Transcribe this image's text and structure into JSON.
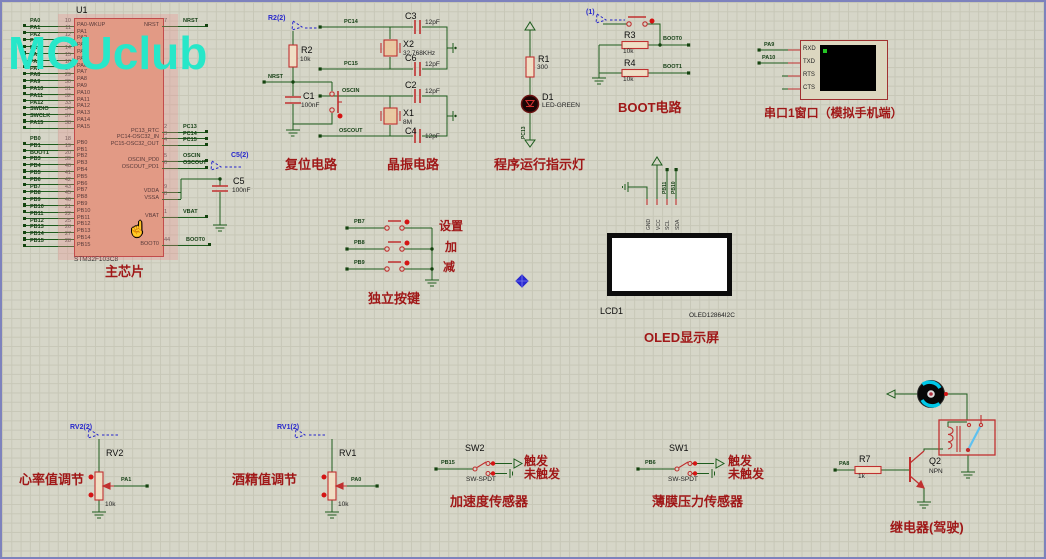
{
  "watermark": "MCUclub",
  "colors": {
    "wire_green": "#1d5c1d",
    "component_red": "#c03030",
    "caption_red": "#a01818",
    "probe_blue": "#2828cc",
    "watermark_teal": "#27e7c9",
    "chip_fill": "#dfa183",
    "grid_bg": "#d6d6c8"
  },
  "chip": {
    "ref": "U1",
    "value": "STM32F103C8",
    "caption": "主芯片",
    "pa_pins": [
      {
        "net": "PA0",
        "num": "10",
        "name": "PA0-WKUP"
      },
      {
        "net": "PA1",
        "num": "11",
        "name": "PA1"
      },
      {
        "net": "PA2",
        "num": "12",
        "name": "PA2"
      },
      {
        "net": "PA3",
        "num": "13",
        "name": "PA3"
      },
      {
        "net": "PA4",
        "num": "14",
        "name": "PA4"
      },
      {
        "net": "PA5",
        "num": "15",
        "name": "PA5"
      },
      {
        "net": "PA6",
        "num": "16",
        "name": "PA6"
      },
      {
        "net": "PA7",
        "num": "17",
        "name": "PA7"
      },
      {
        "net": "PA8",
        "num": "29",
        "name": "PA8"
      },
      {
        "net": "PA9",
        "num": "30",
        "name": "PA9"
      },
      {
        "net": "PA10",
        "num": "31",
        "name": "PA10"
      },
      {
        "net": "PA11",
        "num": "32",
        "name": "PA11"
      },
      {
        "net": "PA12",
        "num": "33",
        "name": "PA12"
      },
      {
        "net": "SWDIO",
        "num": "34",
        "name": "PA13"
      },
      {
        "net": "SWCLK",
        "num": "37",
        "name": "PA14"
      },
      {
        "net": "PA15",
        "num": "38",
        "name": "PA15"
      }
    ],
    "pb_pins": [
      {
        "net": "PB0",
        "num": "18",
        "name": "PB0"
      },
      {
        "net": "PB1",
        "num": "19",
        "name": "PB1"
      },
      {
        "net": "BOOT1",
        "num": "20",
        "name": "PB2"
      },
      {
        "net": "PB3",
        "num": "39",
        "name": "PB3"
      },
      {
        "net": "PB4",
        "num": "40",
        "name": "PB4"
      },
      {
        "net": "PB5",
        "num": "41",
        "name": "PB5"
      },
      {
        "net": "PB6",
        "num": "42",
        "name": "PB6"
      },
      {
        "net": "PB7",
        "num": "43",
        "name": "PB7"
      },
      {
        "net": "PB8",
        "num": "45",
        "name": "PB8"
      },
      {
        "net": "PB9",
        "num": "46",
        "name": "PB9"
      },
      {
        "net": "PB10",
        "num": "21",
        "name": "PB10"
      },
      {
        "net": "PB11",
        "num": "22",
        "name": "PB11"
      },
      {
        "net": "PB12",
        "num": "25",
        "name": "PB12"
      },
      {
        "net": "PB13",
        "num": "26",
        "name": "PB13"
      },
      {
        "net": "PB14",
        "num": "27",
        "name": "PB14"
      },
      {
        "net": "PB15",
        "num": "28",
        "name": "PB15"
      }
    ],
    "right_pins": [
      {
        "name": "NRST",
        "num": "7",
        "net": "NRST"
      },
      {
        "name": "PC13_RTC",
        "num": "2",
        "net": "PC13"
      },
      {
        "name": "PC14-OSC32_IN",
        "num": "3",
        "net": "PC14"
      },
      {
        "name": "PC15-OSC32_OUT",
        "num": "4",
        "net": "PC15"
      },
      {
        "name": "OSCIN_PD0",
        "num": "5",
        "net": "OSCIN"
      },
      {
        "name": "OSCOUT_PD1",
        "num": "6",
        "net": "OSCOUT"
      },
      {
        "name": "VDDA",
        "num": "9",
        "net": ""
      },
      {
        "name": "VSSA",
        "num": "8",
        "net": ""
      },
      {
        "name": "VBAT",
        "num": "1",
        "net": "VBAT"
      },
      {
        "name": "BOOT0",
        "num": "44",
        "net": "BOOT0"
      }
    ]
  },
  "c5": {
    "probe": "C5(2)",
    "ref": "C5",
    "value": "100nF"
  },
  "reset": {
    "probe": "R2(2)",
    "r_ref": "R2",
    "r_value": "10k",
    "net": "NRST",
    "c_ref": "C1",
    "c_value": "100nF",
    "caption": "复位电路"
  },
  "crystal": {
    "caption": "晶振电路",
    "net_pc14": "PC14",
    "net_pc15": "PC15",
    "net_oscin": "OSCIN",
    "net_oscout": "OSCOUT",
    "c3_ref": "C3",
    "c3_value": "12pF",
    "c6_ref": "C6",
    "c6_value": "12pF",
    "c2_ref": "C2",
    "c2_value": "12pF",
    "c4_ref": "C4",
    "c4_value": "12pF",
    "x2_ref": "X2",
    "x2_value": "32.768KHz",
    "x1_ref": "X1",
    "x1_value": "8M"
  },
  "indicator": {
    "r_ref": "R1",
    "r_value": "300",
    "d_ref": "D1",
    "d_value": "LED-GREEN",
    "net": "PC13",
    "caption": "程序运行指示灯"
  },
  "boot": {
    "probe": "(1)",
    "r3_ref": "R3",
    "r3_value": "10k",
    "net_boot0": "BOOT0",
    "r4_ref": "R4",
    "r4_value": "10k",
    "net_boot1": "BOOT1",
    "caption": "BOOT电路"
  },
  "serial": {
    "nets": [
      "PA9",
      "PA10"
    ],
    "pins": [
      "RXD",
      "TXD",
      "RTS",
      "CTS"
    ],
    "caption": "串口1窗口（模拟手机端）"
  },
  "keys": {
    "rows": [
      {
        "net": "PB7",
        "label": "设置"
      },
      {
        "net": "PB8",
        "label": "加"
      },
      {
        "net": "PB9",
        "label": "减"
      }
    ],
    "caption": "独立按键"
  },
  "oled": {
    "ref": "LCD1",
    "value": "OLED12864I2C",
    "pins": [
      "GND",
      "VCC",
      "SCL",
      "SDA"
    ],
    "nets": [
      "PB11",
      "PB10"
    ],
    "caption": "OLED显示屏"
  },
  "rv2": {
    "probe": "RV2(2)",
    "ref": "RV2",
    "value": "10k",
    "net": "PA1",
    "caption": "心率值调节"
  },
  "rv1": {
    "probe": "RV1(2)",
    "ref": "RV1",
    "value": "10k",
    "net": "PA0",
    "caption": "酒精值调节"
  },
  "sw2": {
    "ref": "SW2",
    "model": "SW-SPDT",
    "net": "PB15",
    "on_label": "触发",
    "off_label": "未触发",
    "caption": "加速度传感器"
  },
  "sw1": {
    "ref": "SW1",
    "model": "SW-SPDT",
    "net": "PB6",
    "on_label": "触发",
    "off_label": "未触发",
    "caption": "薄膜压力传感器"
  },
  "relay": {
    "net": "PA8",
    "r_ref": "R7",
    "r_value": "1k",
    "q_ref": "Q2",
    "q_value": "NPN",
    "caption": "继电器(驾驶)"
  }
}
